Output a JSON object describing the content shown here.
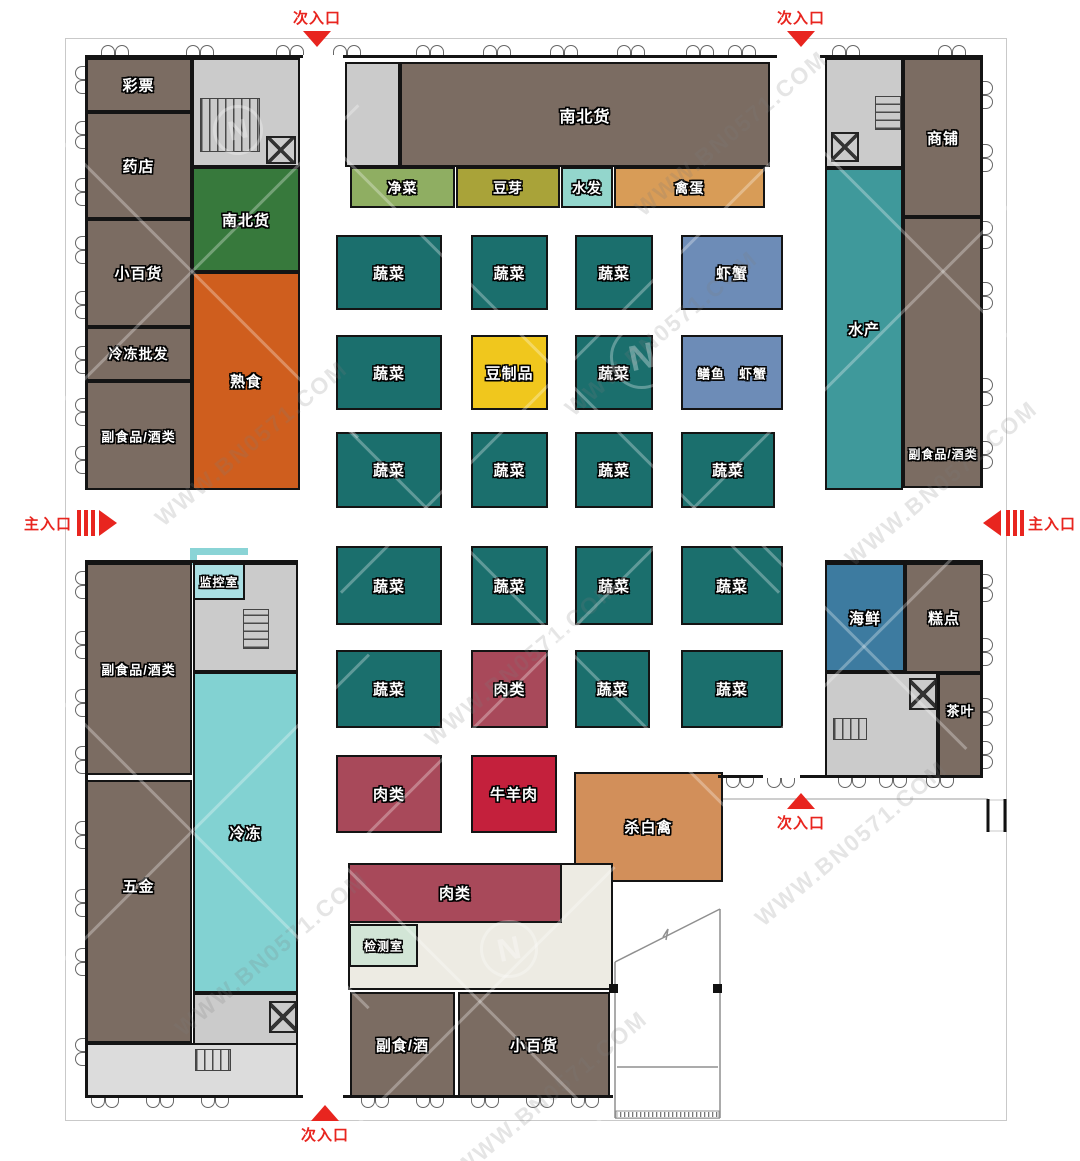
{
  "watermark": {
    "text": "WWW.BN0571.COM",
    "logo_letter": "N"
  },
  "entrance_color": "#e8251f",
  "colors": {
    "brown": "#7b6c62",
    "green": "#37793c",
    "orange": "#cf5e1e",
    "lgreen": "#8fae62",
    "olive": "#a9a339",
    "lcyan": "#93d6cc",
    "tan": "#d89c57",
    "teal": "#1b6f6d",
    "blue": "#6d8cb7",
    "yellow": "#f0c71d",
    "maroon": "#a8495a",
    "red2": "#c4203c",
    "ptan": "#d28f5a",
    "aqua": "#3f999b",
    "frozen": "#82d2d2",
    "sblue": "#3d7ba0",
    "mint": "#d2e5d6",
    "monitor": "#aadfe3",
    "gray": "#cbcbcb",
    "lgray": "#dcdcdc",
    "cream": "#edebe3"
  },
  "rooms": [
    {
      "id": "lottery",
      "label": "彩票",
      "x": 85,
      "y": 58,
      "w": 107,
      "h": 54,
      "c": "brown"
    },
    {
      "id": "pharmacy",
      "label": "药店",
      "x": 85,
      "y": 112,
      "w": 107,
      "h": 107,
      "c": "brown"
    },
    {
      "id": "general-store-left",
      "label": "小百货",
      "x": 85,
      "y": 219,
      "w": 107,
      "h": 108,
      "c": "brown"
    },
    {
      "id": "frozen-wholesale",
      "label": "冷冻批发",
      "x": 85,
      "y": 327,
      "w": 107,
      "h": 54,
      "c": "brown",
      "fs": 14
    },
    {
      "id": "nonstaple-liquor-left-upper",
      "label": "副食品/酒类",
      "x": 85,
      "y": 381,
      "w": 107,
      "h": 109,
      "c": "brown",
      "fs": 13
    },
    {
      "id": "stairwell-top-left",
      "label": "",
      "x": 192,
      "y": 58,
      "w": 108,
      "h": 109,
      "c": "gray",
      "stairs": [
        6,
        38,
        60,
        54,
        "h"
      ],
      "elevator": [
        72,
        76,
        30,
        28
      ]
    },
    {
      "id": "north-south-goods-small",
      "label": "南北货",
      "x": 192,
      "y": 167,
      "w": 108,
      "h": 105,
      "c": "green"
    },
    {
      "id": "cooked-food",
      "label": "熟食",
      "x": 192,
      "y": 272,
      "w": 108,
      "h": 218,
      "c": "orange"
    },
    {
      "id": "entry-room-top",
      "label": "",
      "x": 345,
      "y": 62,
      "w": 55,
      "h": 105,
      "c": "gray"
    },
    {
      "id": "north-south-goods-main",
      "label": "南北货",
      "x": 400,
      "y": 62,
      "w": 370,
      "h": 105,
      "c": "brown",
      "fs": 16
    },
    {
      "id": "clean-vegetables",
      "label": "净菜",
      "x": 350,
      "y": 167,
      "w": 105,
      "h": 41,
      "c": "lgreen",
      "fs": 14
    },
    {
      "id": "bean-sprouts",
      "label": "豆芽",
      "x": 456,
      "y": 167,
      "w": 104,
      "h": 41,
      "c": "olive",
      "fs": 14
    },
    {
      "id": "soaked-goods",
      "label": "水发",
      "x": 561,
      "y": 167,
      "w": 52,
      "h": 41,
      "c": "lcyan",
      "fs": 14
    },
    {
      "id": "poultry-eggs",
      "label": "禽蛋",
      "x": 614,
      "y": 167,
      "w": 151,
      "h": 41,
      "c": "tan",
      "fs": 14
    },
    {
      "id": "stairwell-top-right",
      "label": "",
      "x": 825,
      "y": 58,
      "w": 78,
      "h": 110,
      "c": "gray",
      "stairs": [
        48,
        36,
        26,
        34,
        "v"
      ],
      "elevator": [
        4,
        72,
        28,
        30
      ]
    },
    {
      "id": "aquatic-products",
      "label": "水产",
      "x": 825,
      "y": 168,
      "w": 78,
      "h": 322,
      "c": "aqua"
    },
    {
      "id": "shops",
      "label": "商铺",
      "x": 903,
      "y": 58,
      "w": 80,
      "h": 159,
      "c": "brown"
    },
    {
      "id": "nonstaple-liquor-right",
      "label": "副食品/酒类",
      "x": 903,
      "y": 217,
      "w": 80,
      "h": 271,
      "c": "brown",
      "fs": 12,
      "lt": "88%"
    },
    {
      "id": "veg-r1c1",
      "label": "蔬菜",
      "x": 336,
      "y": 235,
      "w": 106,
      "h": 75,
      "c": "teal"
    },
    {
      "id": "veg-r1c2",
      "label": "蔬菜",
      "x": 471,
      "y": 235,
      "w": 77,
      "h": 75,
      "c": "teal"
    },
    {
      "id": "veg-r1c3",
      "label": "蔬菜",
      "x": 575,
      "y": 235,
      "w": 78,
      "h": 75,
      "c": "teal"
    },
    {
      "id": "shrimp-crab",
      "label": "虾蟹",
      "x": 681,
      "y": 235,
      "w": 102,
      "h": 75,
      "c": "blue"
    },
    {
      "id": "veg-r2c1",
      "label": "蔬菜",
      "x": 336,
      "y": 335,
      "w": 106,
      "h": 75,
      "c": "teal"
    },
    {
      "id": "bean-products",
      "label": "豆制品",
      "x": 471,
      "y": 335,
      "w": 77,
      "h": 75,
      "c": "yellow"
    },
    {
      "id": "veg-r2c3",
      "label": "蔬菜",
      "x": 575,
      "y": 335,
      "w": 78,
      "h": 75,
      "c": "teal"
    },
    {
      "id": "eel-shrimp-crab",
      "label": "鳝鱼　虾蟹",
      "x": 681,
      "y": 335,
      "w": 102,
      "h": 75,
      "c": "blue",
      "fs": 13
    },
    {
      "id": "veg-r3c1",
      "label": "蔬菜",
      "x": 336,
      "y": 432,
      "w": 106,
      "h": 76,
      "c": "teal"
    },
    {
      "id": "veg-r3c2",
      "label": "蔬菜",
      "x": 471,
      "y": 432,
      "w": 77,
      "h": 76,
      "c": "teal"
    },
    {
      "id": "veg-r3c3",
      "label": "蔬菜",
      "x": 575,
      "y": 432,
      "w": 78,
      "h": 76,
      "c": "teal"
    },
    {
      "id": "veg-r3c4",
      "label": "蔬菜",
      "x": 681,
      "y": 432,
      "w": 94,
      "h": 76,
      "c": "teal"
    },
    {
      "id": "veg-r4c1",
      "label": "蔬菜",
      "x": 336,
      "y": 546,
      "w": 106,
      "h": 79,
      "c": "teal"
    },
    {
      "id": "veg-r4c2",
      "label": "蔬菜",
      "x": 471,
      "y": 546,
      "w": 77,
      "h": 79,
      "c": "teal"
    },
    {
      "id": "veg-r4c3",
      "label": "蔬菜",
      "x": 575,
      "y": 546,
      "w": 78,
      "h": 79,
      "c": "teal"
    },
    {
      "id": "veg-r4c4",
      "label": "蔬菜",
      "x": 681,
      "y": 546,
      "w": 102,
      "h": 79,
      "c": "teal"
    },
    {
      "id": "veg-r5c1",
      "label": "蔬菜",
      "x": 336,
      "y": 650,
      "w": 106,
      "h": 78,
      "c": "teal"
    },
    {
      "id": "meat-r5c2",
      "label": "肉类",
      "x": 471,
      "y": 650,
      "w": 77,
      "h": 78,
      "c": "maroon"
    },
    {
      "id": "veg-r5c3",
      "label": "蔬菜",
      "x": 575,
      "y": 650,
      "w": 75,
      "h": 78,
      "c": "teal"
    },
    {
      "id": "veg-r5c4",
      "label": "蔬菜",
      "x": 681,
      "y": 650,
      "w": 102,
      "h": 78,
      "c": "teal"
    },
    {
      "id": "meat-r6c1",
      "label": "肉类",
      "x": 336,
      "y": 755,
      "w": 106,
      "h": 78,
      "c": "maroon"
    },
    {
      "id": "beef-mutton",
      "label": "牛羊肉",
      "x": 471,
      "y": 755,
      "w": 86,
      "h": 78,
      "c": "red2"
    },
    {
      "id": "slaughtered-poultry",
      "label": "杀白禽",
      "x": 574,
      "y": 772,
      "w": 149,
      "h": 110,
      "c": "ptan"
    },
    {
      "id": "seafood",
      "label": "海鲜",
      "x": 825,
      "y": 563,
      "w": 80,
      "h": 109,
      "c": "sblue"
    },
    {
      "id": "pastry",
      "label": "糕点",
      "x": 905,
      "y": 563,
      "w": 78,
      "h": 110,
      "c": "brown"
    },
    {
      "id": "lobby-right",
      "label": "",
      "x": 825,
      "y": 672,
      "w": 113,
      "h": 106,
      "c": "gray",
      "stairs": [
        6,
        44,
        34,
        22,
        "h"
      ],
      "elevator": [
        82,
        4,
        28,
        32
      ]
    },
    {
      "id": "tea",
      "label": "茶叶",
      "x": 938,
      "y": 673,
      "w": 45,
      "h": 105,
      "c": "brown",
      "fs": 13,
      "lt": "35%"
    },
    {
      "id": "stairwell-mid-left",
      "label": "",
      "x": 193,
      "y": 563,
      "w": 105,
      "h": 109,
      "c": "gray",
      "stairs": [
        48,
        44,
        26,
        40,
        "v"
      ]
    },
    {
      "id": "monitor-room",
      "label": "监控室",
      "x": 193,
      "y": 563,
      "w": 52,
      "h": 37,
      "c": "monitor",
      "fs": 12
    },
    {
      "id": "nonstaple-liquor-left-lower",
      "label": "副食品/酒类",
      "x": 85,
      "y": 563,
      "w": 107,
      "h": 212,
      "c": "brown",
      "fs": 13
    },
    {
      "id": "hardware",
      "label": "五金",
      "x": 85,
      "y": 780,
      "w": 107,
      "h": 263,
      "c": "brown",
      "lt": "40%"
    },
    {
      "id": "frozen",
      "label": "冷冻",
      "x": 193,
      "y": 672,
      "w": 105,
      "h": 321,
      "c": "frozen"
    },
    {
      "id": "stairwell-bottom-left",
      "label": "",
      "x": 193,
      "y": 993,
      "w": 105,
      "h": 52,
      "c": "gray",
      "elevator": [
        74,
        6,
        28,
        32
      ]
    },
    {
      "id": "lobby-bottom-left",
      "label": "",
      "x": 85,
      "y": 1043,
      "w": 213,
      "h": 54,
      "c": "lgray",
      "stairs": [
        108,
        4,
        36,
        22,
        "h"
      ]
    },
    {
      "id": "service-area-bottom",
      "label": "",
      "x": 348,
      "y": 863,
      "w": 265,
      "h": 127,
      "c": "cream"
    },
    {
      "id": "meat-bottom",
      "label": "肉类",
      "x": 348,
      "y": 863,
      "w": 214,
      "h": 60,
      "c": "maroon"
    },
    {
      "id": "testing-room",
      "label": "检测室",
      "x": 349,
      "y": 924,
      "w": 69,
      "h": 43,
      "c": "mint",
      "fs": 12
    },
    {
      "id": "nonstaple-liquor-bottom",
      "label": "副食/酒",
      "x": 350,
      "y": 992,
      "w": 105,
      "h": 106,
      "c": "brown"
    },
    {
      "id": "general-store-bottom",
      "label": "小百货",
      "x": 458,
      "y": 992,
      "w": 152,
      "h": 106,
      "c": "brown"
    }
  ],
  "entrances": [
    {
      "id": "secondary-entrance-top-left",
      "label": "次入口",
      "dir": "down",
      "x": 317,
      "y": 7
    },
    {
      "id": "secondary-entrance-top-right",
      "label": "次入口",
      "dir": "down",
      "x": 801,
      "y": 7
    },
    {
      "id": "main-entrance-left",
      "label": "主入口",
      "dir": "right",
      "x": 24,
      "y": 510
    },
    {
      "id": "main-entrance-right",
      "label": "主入口",
      "dir": "left",
      "x": 983,
      "y": 510
    },
    {
      "id": "secondary-entrance-right",
      "label": "次入口",
      "dir": "up",
      "x": 801,
      "y": 793
    },
    {
      "id": "secondary-entrance-bottom",
      "label": "次入口",
      "dir": "up",
      "x": 325,
      "y": 1105
    }
  ]
}
